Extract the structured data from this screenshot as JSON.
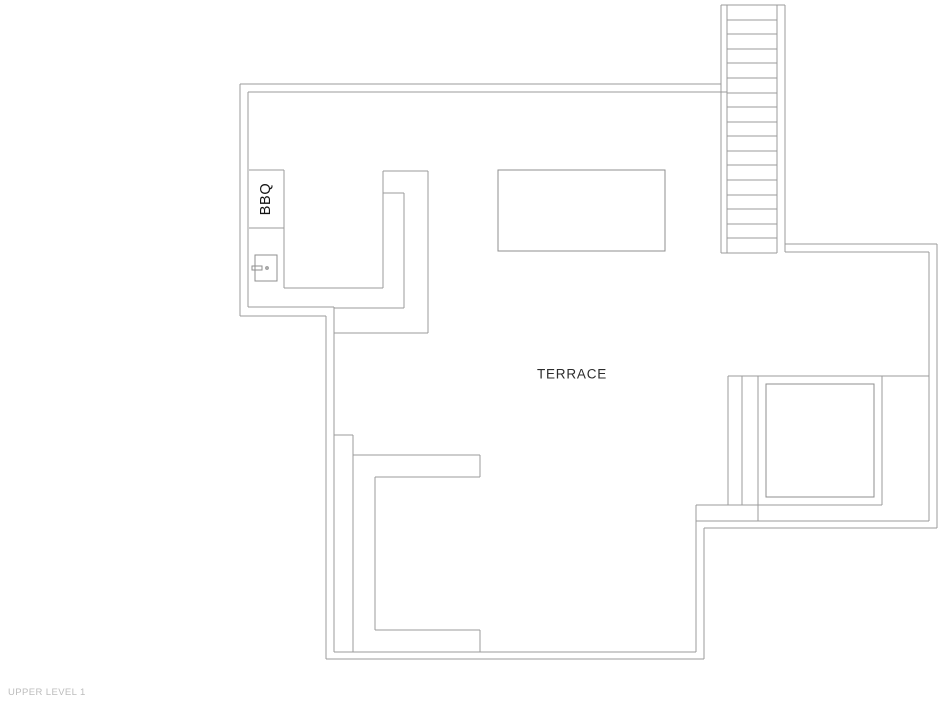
{
  "page": {
    "background": "#ffffff",
    "width": 943,
    "height": 712
  },
  "labels": {
    "terrace": {
      "text": "TERRACE"
    },
    "bbq": {
      "text": "BBQ"
    }
  },
  "footer": {
    "level_title": "UPPER LEVEL 1",
    "color": "#bcbcbc"
  },
  "plan": {
    "wall_stroke": "#9b9b9b",
    "object_stroke": "#8f8f8f",
    "stroke_width": 1,
    "lines": [
      [
        240,
        84,
        721,
        84
      ],
      [
        240,
        84,
        240,
        316
      ],
      [
        240,
        316,
        326,
        316
      ],
      [
        326,
        316,
        326,
        659
      ],
      [
        326,
        659,
        704,
        659
      ],
      [
        704,
        528,
        704,
        659
      ],
      [
        704,
        528,
        937,
        528
      ],
      [
        937,
        244,
        937,
        528
      ],
      [
        785,
        244,
        937,
        244
      ],
      [
        248,
        92,
        727,
        92
      ],
      [
        248,
        92,
        248,
        307
      ],
      [
        248,
        307,
        334,
        307
      ],
      [
        334,
        307,
        334,
        652
      ],
      [
        334,
        652,
        696,
        652
      ],
      [
        696,
        505,
        696,
        652
      ],
      [
        696,
        521,
        929,
        521
      ],
      [
        929,
        252,
        929,
        521
      ],
      [
        785,
        252,
        929,
        252
      ],
      [
        721,
        5,
        785,
        5
      ],
      [
        721,
        5,
        721,
        253
      ],
      [
        727,
        5,
        727,
        253
      ],
      [
        777,
        5,
        777,
        253
      ],
      [
        785,
        5,
        785,
        252
      ],
      [
        721,
        253,
        777,
        253
      ],
      [
        727,
        20,
        777,
        20
      ],
      [
        727,
        34,
        777,
        34
      ],
      [
        727,
        49,
        777,
        49
      ],
      [
        727,
        63,
        777,
        63
      ],
      [
        727,
        78,
        777,
        78
      ],
      [
        727,
        93,
        777,
        93
      ],
      [
        727,
        107,
        777,
        107
      ],
      [
        727,
        122,
        777,
        122
      ],
      [
        727,
        136,
        777,
        136
      ],
      [
        727,
        151,
        777,
        151
      ],
      [
        727,
        165,
        777,
        165
      ],
      [
        727,
        180,
        777,
        180
      ],
      [
        727,
        195,
        777,
        195
      ],
      [
        727,
        209,
        777,
        209
      ],
      [
        727,
        224,
        777,
        224
      ],
      [
        727,
        238,
        777,
        238
      ],
      [
        249,
        170,
        284,
        170
      ],
      [
        249,
        228,
        284,
        228
      ],
      [
        284,
        170,
        284,
        288
      ],
      [
        284,
        288,
        383,
        288
      ],
      [
        383,
        171,
        383,
        288
      ],
      [
        383,
        171,
        428,
        171
      ],
      [
        428,
        171,
        428,
        333
      ],
      [
        334,
        333,
        428,
        333
      ],
      [
        404,
        193,
        404,
        308
      ],
      [
        383,
        193,
        404,
        193
      ],
      [
        334,
        308,
        404,
        308
      ],
      [
        334,
        435,
        353,
        435
      ],
      [
        353,
        435,
        353,
        652
      ],
      [
        353,
        455,
        480,
        455
      ],
      [
        480,
        455,
        480,
        477
      ],
      [
        375,
        477,
        480,
        477
      ],
      [
        375,
        477,
        375,
        630
      ],
      [
        375,
        630,
        480,
        630
      ],
      [
        480,
        630,
        480,
        652
      ],
      [
        728,
        376,
        929,
        376
      ],
      [
        728,
        376,
        728,
        505
      ],
      [
        742,
        376,
        742,
        505
      ],
      [
        758,
        376,
        758,
        521
      ],
      [
        696,
        505,
        882,
        505
      ],
      [
        882,
        376,
        882,
        505
      ]
    ],
    "rects": [
      [
        498,
        170,
        167,
        81
      ],
      [
        766,
        384,
        108,
        113
      ],
      [
        255,
        255,
        22,
        26
      ],
      [
        252,
        266,
        10,
        4
      ]
    ],
    "circles": [
      [
        267,
        268,
        1.3
      ]
    ]
  }
}
